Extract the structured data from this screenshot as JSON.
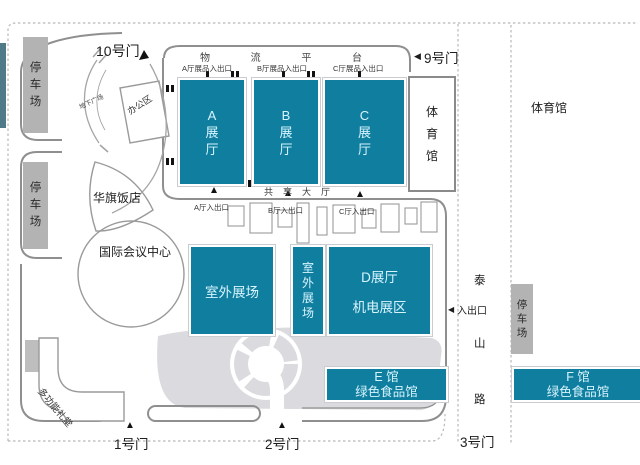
{
  "map": {
    "gates": {
      "g10": "10号门",
      "g9": "9号门",
      "g1": "1号门",
      "g2": "2号门",
      "g3": "3号门"
    },
    "platform": {
      "chars": [
        "物",
        "流",
        "平",
        "台"
      ]
    },
    "freight_entrances": {
      "a": "A厅展品入出口",
      "b": "B厅展品入出口",
      "c": "C厅展品入出口"
    },
    "halls": {
      "a": "A展厅",
      "b": "B展厅",
      "c": "C展厅"
    },
    "shared_hall": "共享大厅",
    "hall_entries": {
      "a": "A厅入出口",
      "b": "B厅入出口",
      "c": "C厅入出口"
    },
    "gym_inner": "体育馆",
    "gym_outer": "体育馆",
    "office": "办公区",
    "underground_plaza": "地下广场",
    "hotel": "华旗饭店",
    "conference_center": "国际会议中心",
    "multi_hall": "多功能礼堂",
    "parking_left_top": "停车场",
    "parking_left_bottom": "停车场",
    "parking_right": "停车场",
    "outdoor_big": "室外展场",
    "outdoor_small": "室外展场",
    "hall_d": {
      "line1": "D展厅",
      "line2": "机电展区"
    },
    "hall_e": {
      "line1": "E 馆",
      "line2": "绿色食品馆"
    },
    "hall_f": {
      "line1": "F 馆",
      "line2": "绿色食品馆"
    },
    "road": {
      "chars": [
        "泰",
        "山",
        "路"
      ],
      "entrance": "入出口"
    },
    "glyphs": {
      "up_triangle": "▲",
      "left_triangle": "◀",
      "gate10_mark": "▲"
    },
    "colors": {
      "hall_teal": "#107f9f",
      "parking_gray": "#b3b3b3",
      "plaza_gray": "#dbdbdf",
      "wall_gray": "#8f8f8f",
      "dotted_gray": "#b8b8b8",
      "edge_strip": "#4f7a87"
    }
  }
}
